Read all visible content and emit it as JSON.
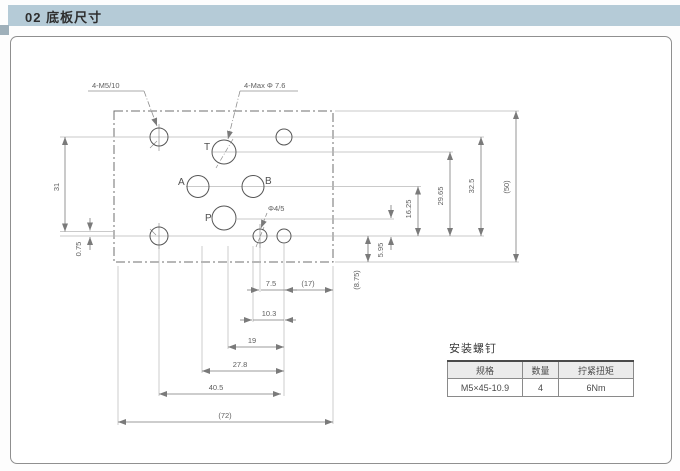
{
  "page": {
    "title": "02 底板尺寸"
  },
  "colors": {
    "header_bar": "#b5cbd7",
    "panel_border": "#8f8f8f",
    "drawing_line": "#6f6f6f",
    "dim_text": "#5f5f5f"
  },
  "drawing": {
    "labels": {
      "bolt_callout": "4-M5/10",
      "port_callout": "4-Max Φ 7.6",
      "pilot_callout": "Φ4/5",
      "port_t": "T",
      "port_a": "A",
      "port_b": "B",
      "port_p": "P"
    },
    "dims": {
      "d31": "31",
      "d075": "0.75",
      "d1625": "16.25",
      "d2965": "29.65",
      "d325": "32.5",
      "d50": "(50)",
      "d595": "5.95",
      "d875": "(8.75)",
      "d75": "7.5",
      "d17": "(17)",
      "d103": "10.3",
      "d19": "19",
      "d278": "27.8",
      "d405": "40.5",
      "d72": "(72)"
    }
  },
  "table": {
    "title": "安装螺钉",
    "headers": [
      "规格",
      "数量",
      "拧紧扭矩"
    ],
    "rows": [
      [
        "M5×45-10.9",
        "4",
        "6Nm"
      ]
    ]
  }
}
